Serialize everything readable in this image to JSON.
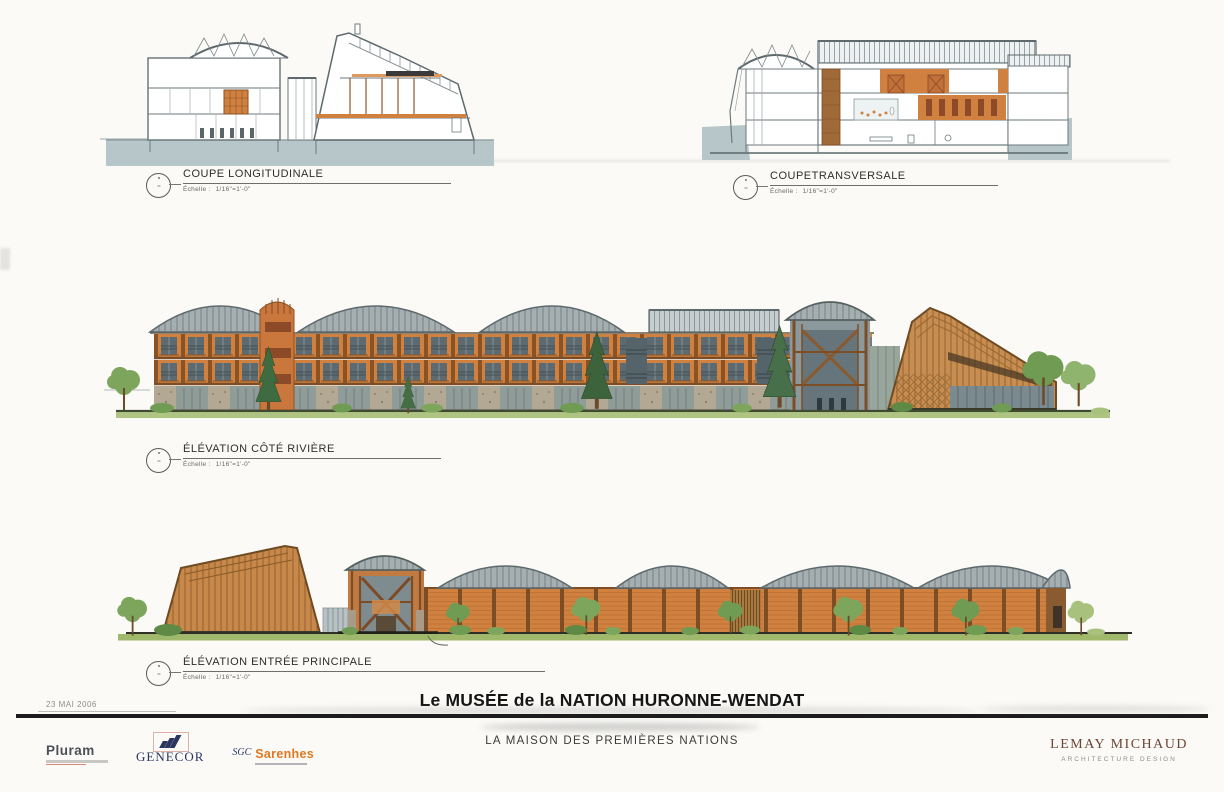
{
  "board": {
    "title": "Le MUSÉE de la NATION HURONNE-WENDAT",
    "subtitle": "LA MAISON DES PREMIÈRES NATIONS",
    "date": "23 MAI 2006"
  },
  "drawings": [
    {
      "id": "coupe-longitudinale",
      "label": "COUPE LONGITUDINALE",
      "scale_label": "Échelle :",
      "scale_value": "1/16\"=1'-0\""
    },
    {
      "id": "coupe-transversale",
      "label": "COUPETRANSVERSALE",
      "scale_label": "Échelle :",
      "scale_value": "1/16\"=1'-0\""
    },
    {
      "id": "elevation-cote-riviere",
      "label": "ÉLÉVATION CÔTÉ RIVIÈRE",
      "scale_label": "Échelle :",
      "scale_value": "1/16\"=1'-0\""
    },
    {
      "id": "elevation-entree-principale",
      "label": "ÉLÉVATION ENTRÉE PRINCIPALE",
      "scale_label": "Échelle :",
      "scale_value": "1/16\"=1'-0\""
    }
  ],
  "logos": {
    "pluram": {
      "name": "Pluram"
    },
    "genecor": {
      "name": "GENECOR"
    },
    "sgc": {
      "prefix": "SGC",
      "name": "Sarenhes"
    }
  },
  "firm": {
    "name": "LEMAY MICHAUD",
    "tagline": "ARCHITECTURE  DESIGN"
  },
  "colors": {
    "wood_orange": "#d0813f",
    "timber_brown": "#7d4e26",
    "roof_gray": "#a5aeb0",
    "section_ground_gray": "#b7c6c9",
    "grass_green": "#a6bd74",
    "firm_brown": "#6e4434",
    "logo_navy": "#2a3560",
    "logo_orange": "#e07820"
  }
}
